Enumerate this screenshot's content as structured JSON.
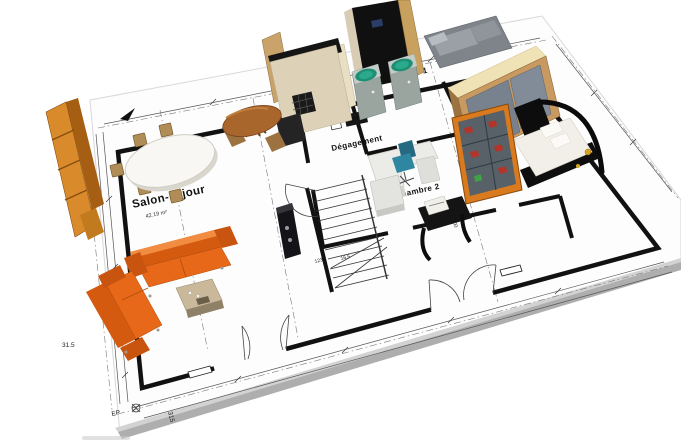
{
  "rooms": {
    "salon": {
      "name": "Salon-séjour",
      "area": "42.19 m²"
    },
    "cuisine": {
      "name": "Cuisine"
    },
    "degagement": {
      "name": "Dégagement"
    },
    "chambre1": {
      "name": "Chambre 1"
    },
    "chambre2": {
      "name": "Chambre 2"
    },
    "sdb": {
      "name": "SDB"
    }
  },
  "annotations": {
    "downspout": "EP"
  },
  "dimensions": {
    "left_wall": "31.5",
    "bottom_wall": "315",
    "coffee_table": "37",
    "stair_a": "123",
    "stair_b": "16.5",
    "chambre2_wall": "300"
  },
  "colors": {
    "sofa_orange": "#e8681a",
    "shelf_orange": "#d98a2b",
    "wood": "#c89a62",
    "appliance_teal": "#2aa98c",
    "chair_teal": "#2e86a0",
    "cabinet_red": "#b5342a",
    "blueprint_line": "#1a1a1a",
    "paper": "#fdfdfd"
  }
}
